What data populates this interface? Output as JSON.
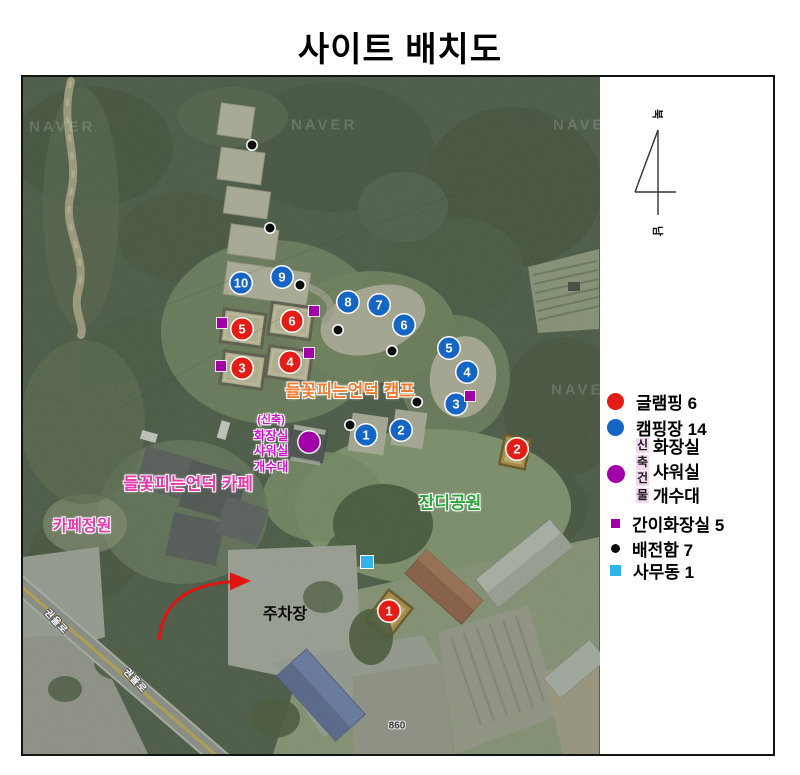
{
  "title": "사이트 배치도",
  "compass": {
    "north": "북",
    "south": "남"
  },
  "legend": {
    "glamping": {
      "label": "글램핑 6",
      "color": "#e41c15"
    },
    "camping": {
      "label": "캠핑장 14",
      "color": "#1565c4"
    },
    "new_building": {
      "vertical_chars": [
        "신",
        "축",
        "건",
        "물"
      ],
      "lines": [
        "화장실",
        "샤워실",
        "개수대"
      ],
      "color": "#a100a8",
      "highlight": "#f3d9f0"
    },
    "portable_toilet": {
      "label": "간이화장실 5",
      "color": "#a100a8"
    },
    "power_box": {
      "label": "배전함 7",
      "color": "#0c0c0c"
    },
    "office": {
      "label": "사무동 1",
      "color": "#2fb4ea"
    }
  },
  "map": {
    "watermark": "NAVER",
    "watermarks": [
      {
        "x": 6,
        "y": 50
      },
      {
        "x": 268,
        "y": 48
      },
      {
        "x": 530,
        "y": 48
      },
      {
        "x": 268,
        "y": 313
      },
      {
        "x": 528,
        "y": 313
      }
    ],
    "labels": [
      {
        "id": "camp-name-label",
        "cls": "lbl-camp outl",
        "text": "들꽃피는언덕 캠프",
        "x": 327,
        "y": 312
      },
      {
        "id": "cafe-name-label",
        "cls": "lbl-cafe outl",
        "text": "들꽃피는언덕 카페",
        "x": 165,
        "y": 405
      },
      {
        "id": "cafe-garden-label",
        "cls": "lbl-cafe2 outl",
        "text": "카페정원",
        "x": 59,
        "y": 447
      },
      {
        "id": "lawn-park-label",
        "cls": "lbl-lawn outl",
        "text": "잔디공원",
        "x": 427,
        "y": 424
      },
      {
        "id": "parking-label",
        "cls": "lbl-parking",
        "text": "주차장",
        "x": 262,
        "y": 535
      },
      {
        "id": "road-name-label",
        "cls": "lbl-road",
        "text": "권율로",
        "x": 34,
        "y": 544,
        "rot": 47
      },
      {
        "id": "road-name-label",
        "cls": "lbl-road",
        "text": "권율로",
        "x": 113,
        "y": 603,
        "rot": 47
      },
      {
        "id": "lot-number-label",
        "cls": "lbl-lot",
        "text": "860",
        "x": 374,
        "y": 649
      }
    ],
    "new_building_note": {
      "lines": [
        "(신축)",
        "화장실",
        "샤워실",
        "개수대"
      ],
      "x": 248,
      "y": 336
    },
    "markers": {
      "glamping": [
        {
          "n": 1,
          "x": 366,
          "y": 534
        },
        {
          "n": 2,
          "x": 494,
          "y": 372
        },
        {
          "n": 3,
          "x": 219,
          "y": 291
        },
        {
          "n": 4,
          "x": 267,
          "y": 285
        },
        {
          "n": 5,
          "x": 219,
          "y": 252
        },
        {
          "n": 6,
          "x": 269,
          "y": 244
        }
      ],
      "camping": [
        {
          "n": 1,
          "x": 343,
          "y": 358
        },
        {
          "n": 2,
          "x": 378,
          "y": 353
        },
        {
          "n": 3,
          "x": 433,
          "y": 327
        },
        {
          "n": 4,
          "x": 444,
          "y": 295
        },
        {
          "n": 5,
          "x": 426,
          "y": 271
        },
        {
          "n": 6,
          "x": 381,
          "y": 248
        },
        {
          "n": 7,
          "x": 356,
          "y": 228
        },
        {
          "n": 8,
          "x": 325,
          "y": 225
        },
        {
          "n": 9,
          "x": 259,
          "y": 200
        },
        {
          "n": 10,
          "x": 218,
          "y": 206
        }
      ],
      "portable_toilets": [
        {
          "x": 199,
          "y": 246
        },
        {
          "x": 291,
          "y": 234
        },
        {
          "x": 198,
          "y": 289
        },
        {
          "x": 286,
          "y": 276
        },
        {
          "x": 447,
          "y": 319
        }
      ],
      "power_boxes": [
        {
          "x": 229,
          "y": 68
        },
        {
          "x": 247,
          "y": 151
        },
        {
          "x": 277,
          "y": 208
        },
        {
          "x": 315,
          "y": 253
        },
        {
          "x": 369,
          "y": 274
        },
        {
          "x": 394,
          "y": 325
        },
        {
          "x": 327,
          "y": 348
        }
      ],
      "new_building": {
        "x": 286,
        "y": 365
      },
      "office": {
        "x": 344,
        "y": 485
      }
    }
  }
}
